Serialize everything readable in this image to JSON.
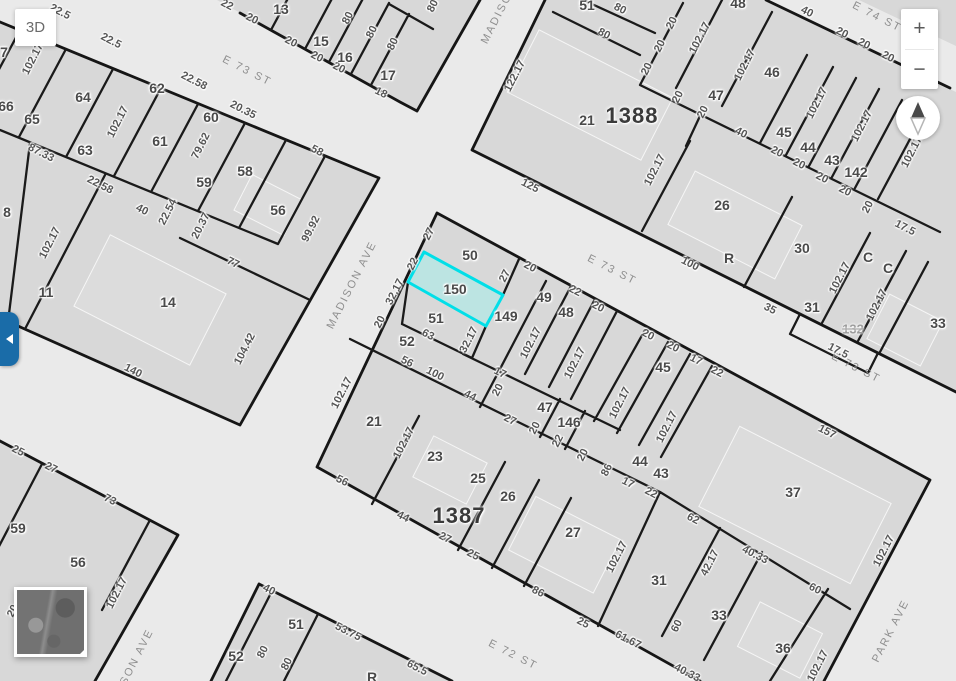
{
  "controls": {
    "view3d": "3D",
    "zoom_in": "+",
    "zoom_out": "−"
  },
  "colors": {
    "highlight_fill": "#b7e6e4",
    "highlight_stroke": "#00dfe8",
    "toggle_blue": "#1a6ca8"
  },
  "map": {
    "highlight": {
      "lot": "150",
      "x": 455,
      "y": 289
    },
    "blocks": [
      {
        "t": "1388",
        "x": 632,
        "y": 116
      },
      {
        "t": "1387",
        "x": 459,
        "y": 516
      }
    ],
    "streets": [
      {
        "t": "E 73 ST",
        "x": 247,
        "y": 71,
        "r": 27
      },
      {
        "t": "E 74 ST",
        "x": 877,
        "y": 17,
        "r": 27
      },
      {
        "t": "E 73 ST",
        "x": 612,
        "y": 270,
        "r": 27
      },
      {
        "t": "E 73 ST",
        "x": 856,
        "y": 368,
        "r": 27
      },
      {
        "t": "E 72 ST",
        "x": 513,
        "y": 655,
        "r": 27
      },
      {
        "t": "MADISON",
        "x": 499,
        "y": 14,
        "r": -63
      },
      {
        "t": "MADISON AVE",
        "x": 352,
        "y": 285,
        "r": -63
      },
      {
        "t": "SON AVE",
        "x": 137,
        "y": 657,
        "r": -63
      },
      {
        "t": "PARK AVE",
        "x": 891,
        "y": 631,
        "r": -63
      }
    ],
    "lots": [
      {
        "t": "7",
        "x": 4,
        "y": 52
      },
      {
        "t": "66",
        "x": 6,
        "y": 106
      },
      {
        "t": "65",
        "x": 32,
        "y": 119
      },
      {
        "t": "64",
        "x": 83,
        "y": 97
      },
      {
        "t": "63",
        "x": 85,
        "y": 150
      },
      {
        "t": "62",
        "x": 157,
        "y": 88
      },
      {
        "t": "61",
        "x": 160,
        "y": 141
      },
      {
        "t": "60",
        "x": 211,
        "y": 117
      },
      {
        "t": "59",
        "x": 204,
        "y": 182
      },
      {
        "t": "58",
        "x": 245,
        "y": 171
      },
      {
        "t": "56",
        "x": 278,
        "y": 210
      },
      {
        "t": "8",
        "x": 7,
        "y": 212
      },
      {
        "t": "11",
        "x": 46,
        "y": 292
      },
      {
        "t": "14",
        "x": 168,
        "y": 302
      },
      {
        "t": "13",
        "x": 281,
        "y": 9
      },
      {
        "t": "15",
        "x": 321,
        "y": 41
      },
      {
        "t": "16",
        "x": 345,
        "y": 57
      },
      {
        "t": "17",
        "x": 388,
        "y": 75
      },
      {
        "t": "51",
        "x": 587,
        "y": 5
      },
      {
        "t": "48",
        "x": 738,
        "y": 3
      },
      {
        "t": "21",
        "x": 587,
        "y": 120
      },
      {
        "t": "47",
        "x": 716,
        "y": 95
      },
      {
        "t": "46",
        "x": 772,
        "y": 72
      },
      {
        "t": "45",
        "x": 784,
        "y": 132
      },
      {
        "t": "44",
        "x": 808,
        "y": 147
      },
      {
        "t": "43",
        "x": 832,
        "y": 160
      },
      {
        "t": "142",
        "x": 856,
        "y": 172
      },
      {
        "t": "26",
        "x": 722,
        "y": 205
      },
      {
        "t": "30",
        "x": 802,
        "y": 248
      },
      {
        "t": "R",
        "x": 729,
        "y": 258
      },
      {
        "t": "C",
        "x": 868,
        "y": 257
      },
      {
        "t": "C",
        "x": 888,
        "y": 268
      },
      {
        "t": "31",
        "x": 812,
        "y": 307
      },
      {
        "t": "33",
        "x": 938,
        "y": 323
      },
      {
        "t": "50",
        "x": 470,
        "y": 255
      },
      {
        "t": "51",
        "x": 436,
        "y": 318
      },
      {
        "t": "149",
        "x": 506,
        "y": 316
      },
      {
        "t": "49",
        "x": 544,
        "y": 297
      },
      {
        "t": "48",
        "x": 566,
        "y": 312
      },
      {
        "t": "52",
        "x": 407,
        "y": 341
      },
      {
        "t": "21",
        "x": 374,
        "y": 421
      },
      {
        "t": "23",
        "x": 435,
        "y": 456
      },
      {
        "t": "25",
        "x": 478,
        "y": 478
      },
      {
        "t": "26",
        "x": 508,
        "y": 496
      },
      {
        "t": "47",
        "x": 545,
        "y": 407
      },
      {
        "t": "146",
        "x": 569,
        "y": 422
      },
      {
        "t": "45",
        "x": 663,
        "y": 367
      },
      {
        "t": "44",
        "x": 640,
        "y": 461
      },
      {
        "t": "43",
        "x": 661,
        "y": 473
      },
      {
        "t": "27",
        "x": 573,
        "y": 532
      },
      {
        "t": "37",
        "x": 793,
        "y": 492
      },
      {
        "t": "31",
        "x": 659,
        "y": 580
      },
      {
        "t": "33",
        "x": 719,
        "y": 615
      },
      {
        "t": "36",
        "x": 783,
        "y": 648
      },
      {
        "t": "59",
        "x": 18,
        "y": 528
      },
      {
        "t": "56",
        "x": 78,
        "y": 562
      },
      {
        "t": "52",
        "x": 236,
        "y": 656
      },
      {
        "t": "51",
        "x": 296,
        "y": 624
      },
      {
        "t": "R",
        "x": 372,
        "y": 677
      }
    ],
    "retired": [
      {
        "t": "132",
        "x": 853,
        "y": 329
      }
    ],
    "dims": [
      {
        "t": "22.5",
        "x": 60,
        "y": 12,
        "r": 27
      },
      {
        "t": "22.5",
        "x": 111,
        "y": 41,
        "r": 27
      },
      {
        "t": "22.58",
        "x": 194,
        "y": 81,
        "r": 27
      },
      {
        "t": "20.35",
        "x": 243,
        "y": 110,
        "r": 27
      },
      {
        "t": "58",
        "x": 317,
        "y": 151,
        "r": 27
      },
      {
        "t": "87.33",
        "x": 41,
        "y": 153,
        "r": 27
      },
      {
        "t": "22.58",
        "x": 100,
        "y": 185,
        "r": 27
      },
      {
        "t": "40",
        "x": 142,
        "y": 210,
        "r": 27
      },
      {
        "t": "102.17",
        "x": 33,
        "y": 59,
        "r": -63
      },
      {
        "t": "102.17",
        "x": 118,
        "y": 122,
        "r": -63
      },
      {
        "t": "79.62",
        "x": 201,
        "y": 146,
        "r": -63
      },
      {
        "t": "22.54",
        "x": 168,
        "y": 212,
        "r": -63
      },
      {
        "t": "20.37",
        "x": 201,
        "y": 226,
        "r": -63
      },
      {
        "t": "99.92",
        "x": 311,
        "y": 229,
        "r": -63
      },
      {
        "t": "77",
        "x": 233,
        "y": 263,
        "r": 27
      },
      {
        "t": "140",
        "x": 133,
        "y": 371,
        "r": 27
      },
      {
        "t": "104.42",
        "x": 245,
        "y": 349,
        "r": -63
      },
      {
        "t": "102.17",
        "x": 50,
        "y": 243,
        "r": -63
      },
      {
        "t": "22",
        "x": 227,
        "y": 5,
        "r": 27
      },
      {
        "t": "20",
        "x": 252,
        "y": 19,
        "r": 27
      },
      {
        "t": "20",
        "x": 291,
        "y": 42,
        "r": 27
      },
      {
        "t": "20",
        "x": 317,
        "y": 57,
        "r": 27
      },
      {
        "t": "20",
        "x": 339,
        "y": 68,
        "r": 27
      },
      {
        "t": "80",
        "x": 348,
        "y": 18,
        "r": -63
      },
      {
        "t": "80",
        "x": 372,
        "y": 32,
        "r": -63
      },
      {
        "t": "80",
        "x": 393,
        "y": 44,
        "r": -63
      },
      {
        "t": "18",
        "x": 381,
        "y": 93,
        "r": 27
      },
      {
        "t": "80",
        "x": 433,
        "y": 6,
        "r": -63
      },
      {
        "t": "122.17",
        "x": 515,
        "y": 76,
        "r": -63
      },
      {
        "t": "80",
        "x": 620,
        "y": 9,
        "r": 27
      },
      {
        "t": "80",
        "x": 604,
        "y": 34,
        "r": 27
      },
      {
        "t": "20",
        "x": 672,
        "y": 23,
        "r": -63
      },
      {
        "t": "20",
        "x": 660,
        "y": 46,
        "r": -63
      },
      {
        "t": "20",
        "x": 647,
        "y": 69,
        "r": -63
      },
      {
        "t": "20",
        "x": 678,
        "y": 97,
        "r": -63
      },
      {
        "t": "20",
        "x": 703,
        "y": 112,
        "r": -63
      },
      {
        "t": "102.17",
        "x": 700,
        "y": 38,
        "r": -63
      },
      {
        "t": "102.17",
        "x": 745,
        "y": 65,
        "r": -63
      },
      {
        "t": "40",
        "x": 807,
        "y": 12,
        "r": 27
      },
      {
        "t": "20",
        "x": 842,
        "y": 33,
        "r": 27
      },
      {
        "t": "20",
        "x": 864,
        "y": 44,
        "r": 27
      },
      {
        "t": "20",
        "x": 888,
        "y": 57,
        "r": 27
      },
      {
        "t": "102.17",
        "x": 817,
        "y": 103,
        "r": -63
      },
      {
        "t": "102.17",
        "x": 862,
        "y": 126,
        "r": -63
      },
      {
        "t": "102.17",
        "x": 912,
        "y": 152,
        "r": -63
      },
      {
        "t": "40",
        "x": 741,
        "y": 133,
        "r": 27
      },
      {
        "t": "20",
        "x": 777,
        "y": 152,
        "r": 27
      },
      {
        "t": "20",
        "x": 799,
        "y": 164,
        "r": 27
      },
      {
        "t": "20",
        "x": 822,
        "y": 178,
        "r": 27
      },
      {
        "t": "20",
        "x": 845,
        "y": 191,
        "r": 27
      },
      {
        "t": "20",
        "x": 868,
        "y": 207,
        "r": -63
      },
      {
        "t": "17.5",
        "x": 905,
        "y": 228,
        "r": 27
      },
      {
        "t": "125",
        "x": 530,
        "y": 186,
        "r": 27
      },
      {
        "t": "100",
        "x": 690,
        "y": 264,
        "r": 27
      },
      {
        "t": "35",
        "x": 770,
        "y": 309,
        "r": 27
      },
      {
        "t": "102.17",
        "x": 655,
        "y": 170,
        "r": -63
      },
      {
        "t": "102.17",
        "x": 840,
        "y": 278,
        "r": -63
      },
      {
        "t": "102.17",
        "x": 877,
        "y": 305,
        "r": -63
      },
      {
        "t": "17.5",
        "x": 838,
        "y": 351,
        "r": 27
      },
      {
        "t": "27",
        "x": 429,
        "y": 234,
        "r": -63
      },
      {
        "t": "22",
        "x": 413,
        "y": 264,
        "r": -63
      },
      {
        "t": "32.17",
        "x": 395,
        "y": 292,
        "r": -63
      },
      {
        "t": "20",
        "x": 380,
        "y": 322,
        "r": -63
      },
      {
        "t": "27",
        "x": 505,
        "y": 276,
        "r": -63
      },
      {
        "t": "20",
        "x": 530,
        "y": 267,
        "r": 27
      },
      {
        "t": "22",
        "x": 575,
        "y": 291,
        "r": 27
      },
      {
        "t": "20",
        "x": 598,
        "y": 307,
        "r": 27
      },
      {
        "t": "63",
        "x": 428,
        "y": 335,
        "r": 27
      },
      {
        "t": "32.17",
        "x": 469,
        "y": 340,
        "r": -63
      },
      {
        "t": "56",
        "x": 407,
        "y": 362,
        "r": 27
      },
      {
        "t": "100",
        "x": 435,
        "y": 374,
        "r": 27
      },
      {
        "t": "17",
        "x": 500,
        "y": 373,
        "r": 27
      },
      {
        "t": "20",
        "x": 498,
        "y": 390,
        "r": -63
      },
      {
        "t": "102.17",
        "x": 531,
        "y": 343,
        "r": -63
      },
      {
        "t": "102.17",
        "x": 575,
        "y": 363,
        "r": -63
      },
      {
        "t": "44",
        "x": 470,
        "y": 396,
        "r": 27
      },
      {
        "t": "102.17",
        "x": 342,
        "y": 393,
        "r": -63
      },
      {
        "t": "102.17",
        "x": 404,
        "y": 443,
        "r": -63
      },
      {
        "t": "27",
        "x": 510,
        "y": 420,
        "r": 27
      },
      {
        "t": "20",
        "x": 535,
        "y": 428,
        "r": -63
      },
      {
        "t": "22",
        "x": 558,
        "y": 441,
        "r": -63
      },
      {
        "t": "20",
        "x": 583,
        "y": 455,
        "r": -63
      },
      {
        "t": "86",
        "x": 607,
        "y": 470,
        "r": -63
      },
      {
        "t": "20",
        "x": 648,
        "y": 335,
        "r": 27
      },
      {
        "t": "20",
        "x": 673,
        "y": 347,
        "r": 27
      },
      {
        "t": "17",
        "x": 696,
        "y": 360,
        "r": 27
      },
      {
        "t": "22",
        "x": 717,
        "y": 372,
        "r": 27
      },
      {
        "t": "102.17",
        "x": 620,
        "y": 403,
        "r": -63
      },
      {
        "t": "102.17",
        "x": 667,
        "y": 427,
        "r": -63
      },
      {
        "t": "157",
        "x": 827,
        "y": 432,
        "r": 27
      },
      {
        "t": "56",
        "x": 342,
        "y": 481,
        "r": 27
      },
      {
        "t": "44",
        "x": 403,
        "y": 517,
        "r": 27
      },
      {
        "t": "27",
        "x": 445,
        "y": 538,
        "r": 27
      },
      {
        "t": "25",
        "x": 473,
        "y": 555,
        "r": 27
      },
      {
        "t": "86",
        "x": 538,
        "y": 592,
        "r": 27
      },
      {
        "t": "102.17",
        "x": 617,
        "y": 557,
        "r": -63
      },
      {
        "t": "62",
        "x": 693,
        "y": 519,
        "r": 27
      },
      {
        "t": "17",
        "x": 628,
        "y": 483,
        "r": 27
      },
      {
        "t": "22",
        "x": 651,
        "y": 493,
        "r": 27
      },
      {
        "t": "42.17",
        "x": 710,
        "y": 563,
        "r": -63
      },
      {
        "t": "40.33",
        "x": 755,
        "y": 555,
        "r": 27
      },
      {
        "t": "60",
        "x": 815,
        "y": 589,
        "r": 27
      },
      {
        "t": "102.17",
        "x": 884,
        "y": 551,
        "r": -63
      },
      {
        "t": "60",
        "x": 677,
        "y": 626,
        "r": -63
      },
      {
        "t": "61.67",
        "x": 628,
        "y": 640,
        "r": 27
      },
      {
        "t": "40.33",
        "x": 687,
        "y": 673,
        "r": 27
      },
      {
        "t": "102.17",
        "x": 818,
        "y": 666,
        "r": -63
      },
      {
        "t": "25",
        "x": 18,
        "y": 451,
        "r": 27
      },
      {
        "t": "27",
        "x": 51,
        "y": 468,
        "r": 27
      },
      {
        "t": "73",
        "x": 110,
        "y": 500,
        "r": 27
      },
      {
        "t": "102.17",
        "x": 117,
        "y": 593,
        "r": -63
      },
      {
        "t": "20",
        "x": 13,
        "y": 611,
        "r": -63
      },
      {
        "t": "40",
        "x": 269,
        "y": 590,
        "r": 27
      },
      {
        "t": "80",
        "x": 263,
        "y": 652,
        "r": -63
      },
      {
        "t": "80",
        "x": 287,
        "y": 664,
        "r": -63
      },
      {
        "t": "53.75",
        "x": 348,
        "y": 632,
        "r": 27
      },
      {
        "t": "65.5",
        "x": 417,
        "y": 668,
        "r": 27
      },
      {
        "t": "25",
        "x": 583,
        "y": 623,
        "r": 27
      }
    ]
  }
}
